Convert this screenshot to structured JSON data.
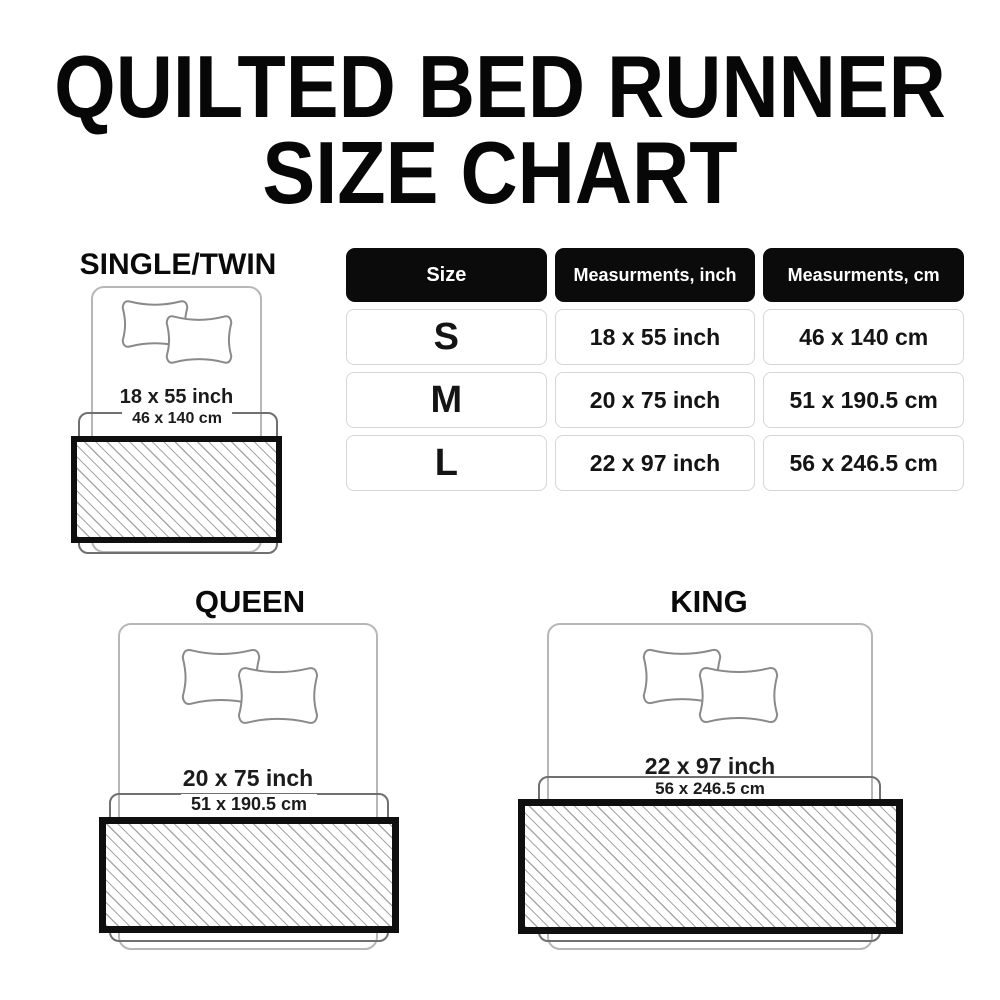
{
  "title": {
    "line1": "QUILTED BED RUNNER",
    "line2": "SIZE CHART"
  },
  "table": {
    "headers": {
      "size": "Size",
      "inch": "Measurments, inch",
      "cm": "Measurments, cm"
    },
    "rows": [
      {
        "size": "S",
        "inch": "18 x 55 inch",
        "cm": "46 x 140 cm"
      },
      {
        "size": "M",
        "inch": "20 x 75 inch",
        "cm": "51 x 190.5 cm"
      },
      {
        "size": "L",
        "inch": "22 x 97 inch",
        "cm": "56 x 246.5 cm"
      }
    ]
  },
  "beds": [
    {
      "id": "single-twin",
      "label": "SINGLE/TWIN",
      "inch": "18 x 55 inch",
      "cm": "46 x 140 cm"
    },
    {
      "id": "queen",
      "label": "QUEEN",
      "inch": "20 x 75 inch",
      "cm": "51 x 190.5 cm"
    },
    {
      "id": "king",
      "label": "KING",
      "inch": "22 x 97 inch",
      "cm": "56 x 246.5 cm"
    }
  ],
  "colors": {
    "header_bg": "#0b0b0b",
    "runner_border": "#0f0f0f",
    "hatch_line": "#a8a8a8",
    "bed_outline": "#b7b7b7",
    "pillow_outline": "#8a8a8a",
    "bracket_outline": "#707070",
    "text": "#1c1c1c"
  }
}
